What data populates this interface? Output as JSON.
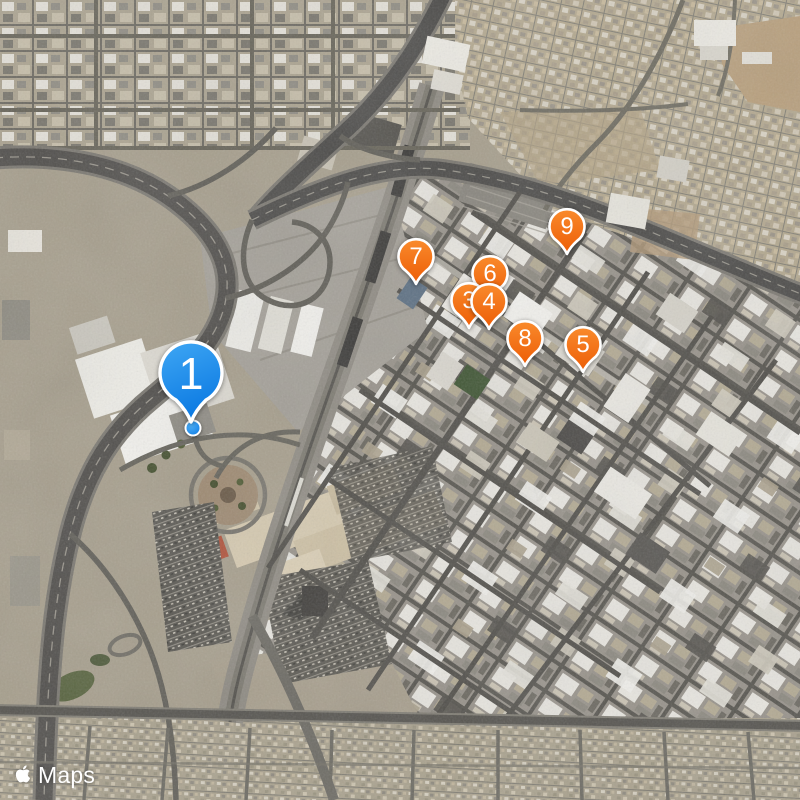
{
  "map": {
    "view_type": "satellite",
    "attribution": {
      "icon": "apple-logo-icon",
      "label": "Maps"
    },
    "user_location_marker": "blue-dot",
    "pins": [
      {
        "label": "1",
        "style": "large-blue-balloon",
        "x": 191,
        "y": 374
      },
      {
        "label": "3",
        "style": "orange-balloon",
        "x": 469,
        "y": 301
      },
      {
        "label": "4",
        "style": "orange-balloon",
        "x": 489,
        "y": 302
      },
      {
        "label": "5",
        "style": "orange-balloon",
        "x": 583,
        "y": 345
      },
      {
        "label": "6",
        "style": "orange-balloon",
        "x": 490,
        "y": 274
      },
      {
        "label": "7",
        "style": "orange-balloon",
        "x": 416,
        "y": 257
      },
      {
        "label": "8",
        "style": "orange-balloon",
        "x": 525,
        "y": 339
      },
      {
        "label": "9",
        "style": "orange-balloon",
        "x": 567,
        "y": 227
      }
    ],
    "colors": {
      "pin_orange": "#F1650A",
      "pin_blue": "#1489EC",
      "terrain_base": "#A69E8C"
    }
  }
}
